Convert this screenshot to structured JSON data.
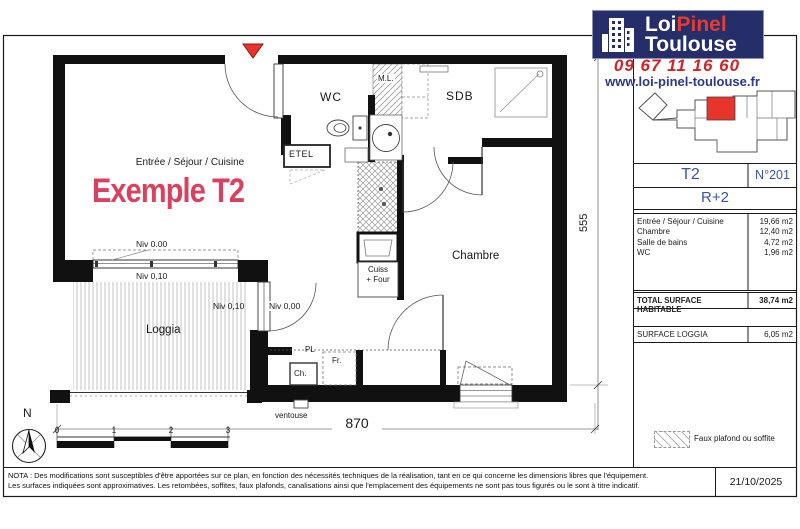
{
  "brand": {
    "logo": {
      "line1_a": "Loi",
      "line1_b": "Pinel",
      "line2": "Toulouse"
    },
    "phone": "09 67 11 16 60",
    "website": "www.loi-pinel-toulouse.fr"
  },
  "sidebar": {
    "unit_type": "T2",
    "unit_number": "N°201",
    "floor": "R+2",
    "rooms": [
      {
        "label": "Entrée / Séjour / Cuisine",
        "value": "19,66",
        "unit": "m2"
      },
      {
        "label": "Chambre",
        "value": "12,40",
        "unit": "m2"
      },
      {
        "label": "Salle de bains",
        "value": "4,72",
        "unit": "m2"
      },
      {
        "label": "WC",
        "value": "1,96",
        "unit": "m2"
      }
    ],
    "total": {
      "label": "TOTAL SURFACE HABITABLE",
      "value": "38,74",
      "unit": "m2"
    },
    "loggia": {
      "label": "SURFACE LOGGIA",
      "value": "6,05",
      "unit": "m2"
    },
    "legend_label": "Faux plafond ou soffite"
  },
  "plan": {
    "room_group_label": "Entrée / Séjour / Cuisine",
    "headline": "Exemple T2",
    "rooms": {
      "wc": "WC",
      "ml": "M.L.",
      "sdb": "SDB",
      "etel": "ETEL",
      "chambre": "Chambre",
      "loggia": "Loggia"
    },
    "kitchen": {
      "line1": "Cuiss",
      "line2": "+ Four"
    },
    "fixtures": {
      "pl": "PL",
      "fr": "Fr.",
      "ch": "Ch.",
      "ventouse": "ventouse"
    },
    "levels": {
      "sejour": "Niv 0.00",
      "loggia_top": "Niv 0,10",
      "loggia_right": "Niv 0,10",
      "door": "Niv 0,00"
    },
    "dimensions": {
      "width": "870",
      "height": "555"
    },
    "scale_ticks": [
      "0",
      "1",
      "2",
      "3"
    ],
    "north": "N"
  },
  "footer": {
    "nota_line1": "NOTA : Des modifications sont susceptibles d'être apportées sur ce plan, en fonction des nécessités techniques de la réalisation, tant en ce qui concerne les dimensions libres que l'équipement.",
    "nota_line2": "Les surfaces indiquées sont approximatives. Les retombées, soffites, faux plafonds, canalisations ainsi que l'emplacement des équipements ne sont pas tous figurés ou le sont à titre indicatif.",
    "date": "21/10/2025"
  },
  "colors": {
    "brand_navy": "#252e68",
    "brand_red": "#d2232a",
    "brand_blue": "#2b3990",
    "headline_pink": "#da415f",
    "unit_highlight_red": "#e8352c"
  }
}
